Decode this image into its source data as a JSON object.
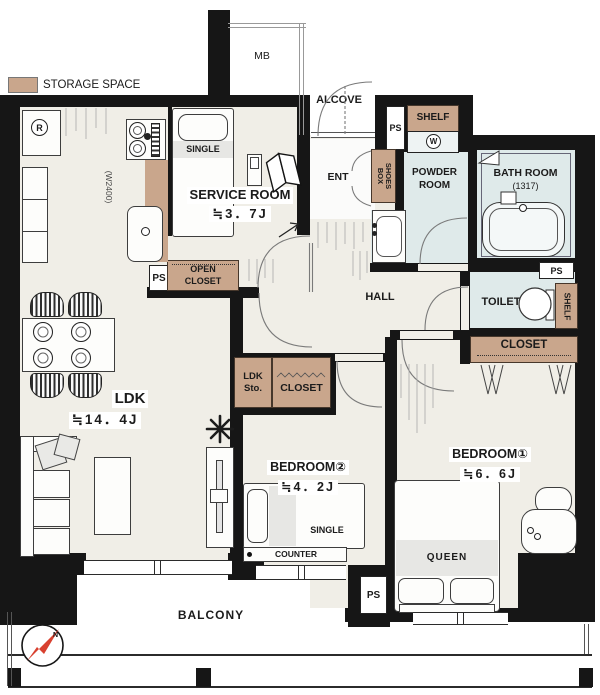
{
  "legend": {
    "label": "STORAGE SPACE"
  },
  "compass": {
    "north": "N"
  },
  "outside": {
    "meter_box": "MB",
    "alcove": "ALCOVE",
    "balcony": "BALCONY"
  },
  "rooms": {
    "service": {
      "name": "SERVICE ROOM",
      "size": "≒3．7J"
    },
    "ldk": {
      "name": "LDK",
      "size": "≒14．4J"
    },
    "bedroom1": {
      "name": "BEDROOM①",
      "size": "≒6．6J"
    },
    "bedroom2": {
      "name": "BEDROOM②",
      "size": "≒4．2J"
    },
    "powder": {
      "name": "POWDER ROOM"
    },
    "bath": {
      "name": "BATH ROOM",
      "size": "(1317)"
    },
    "toilet": {
      "name": "TOILET"
    },
    "hall": {
      "name": "HALL"
    },
    "ent": {
      "name": "ENT"
    }
  },
  "storage": {
    "open_closet": "OPEN CLOSET",
    "closet": "CLOSET",
    "ldk_sto": "LDK Sto.",
    "shoes_box": "SHOES BOX",
    "shelf": "SHELF"
  },
  "fixtures": {
    "ps": "PS",
    "washer": "W",
    "fridge": "R",
    "kitchen_width": "(W2400)",
    "counter": "COUNTER"
  },
  "furniture": {
    "bed_single": "SINGLE",
    "bed_queen": "QUEEN"
  },
  "colors": {
    "wall": "#161616",
    "floor": "#f0eee7",
    "storage": "#c9a68c",
    "wet": "#dfeaea",
    "accent_red": "#d8402f"
  }
}
